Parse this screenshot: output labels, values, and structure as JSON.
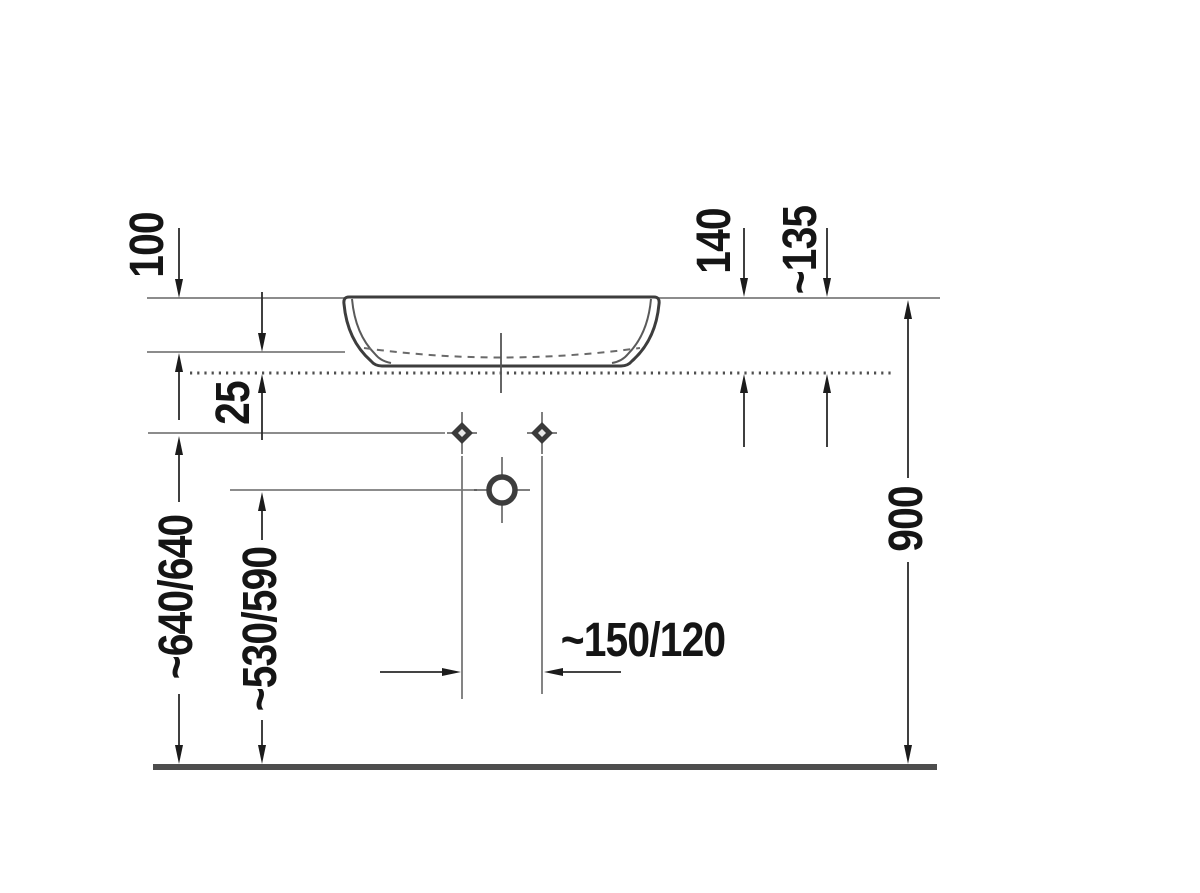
{
  "drawing": {
    "kind": "technical dimension drawing",
    "subject": "above-counter washbasin, side elevation with mounting heights"
  },
  "dimensions": {
    "d100": "100",
    "d25": "25",
    "d140": "140",
    "d135": "~135",
    "d640": "~640/640",
    "d530": "~530/590",
    "d150": "~150/120",
    "d900": "900"
  },
  "colors": {
    "background": "#ffffff",
    "reference_line": "#8c8c8c",
    "drawing_line": "#3d3d3d",
    "dimension_line": "#2a2a2a",
    "text": "#151515"
  }
}
